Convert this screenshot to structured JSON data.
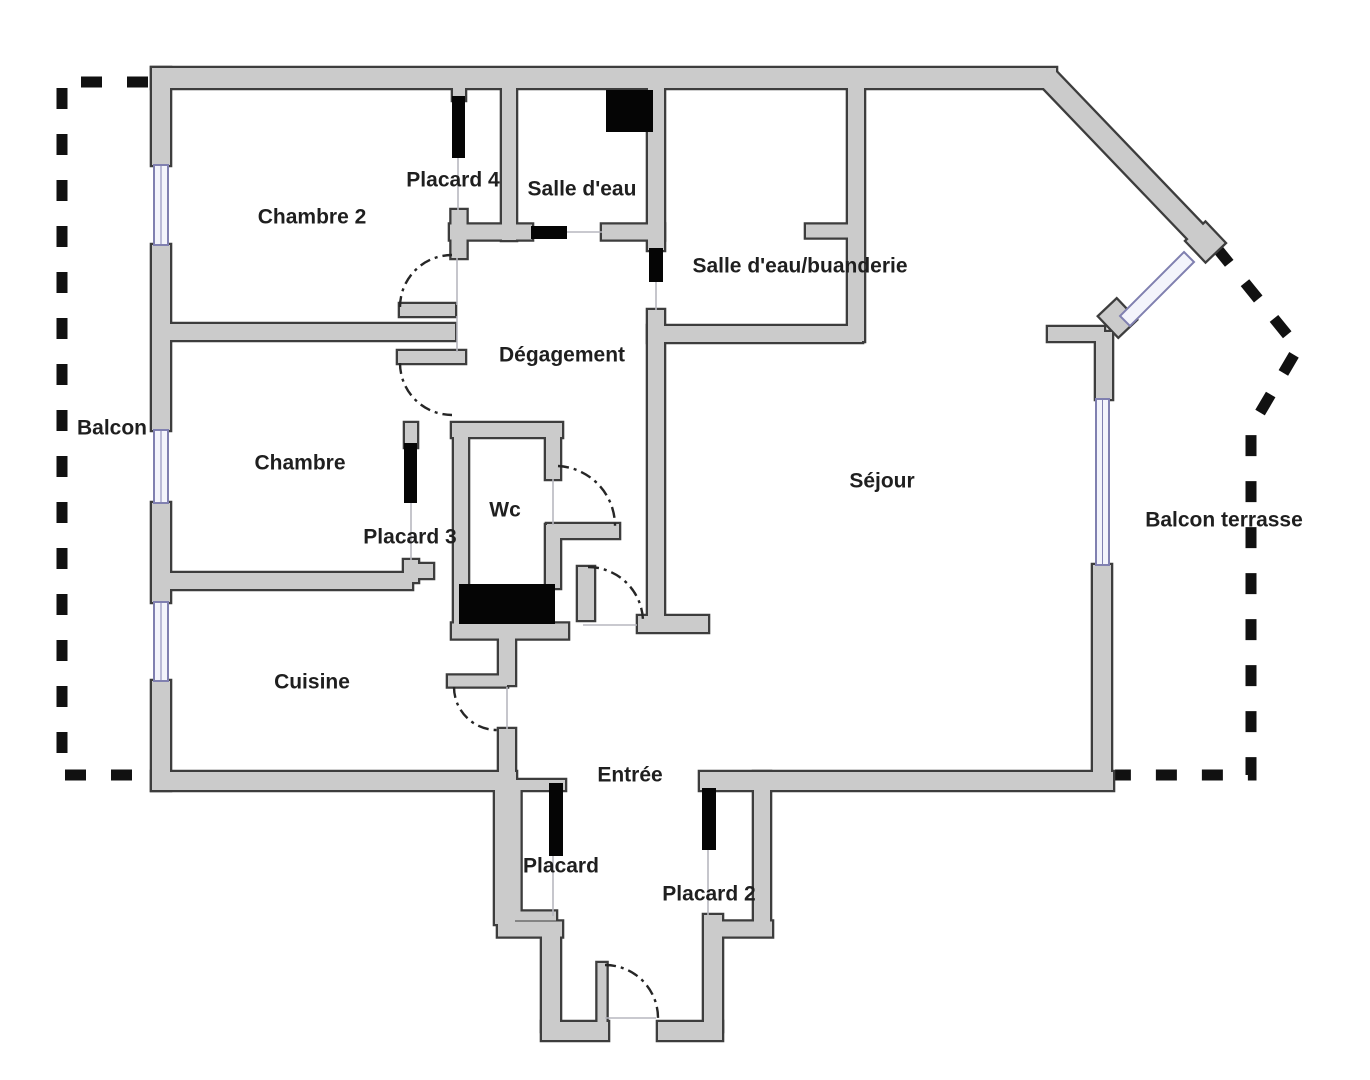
{
  "plan": {
    "kind": "apartment-floor-plan",
    "rooms": [
      {
        "id": "balcon",
        "label": "Balcon"
      },
      {
        "id": "chambre2",
        "label": "Chambre 2"
      },
      {
        "id": "placard4",
        "label": "Placard 4"
      },
      {
        "id": "salle_deau",
        "label": "Salle d'eau"
      },
      {
        "id": "buanderie",
        "label": "Salle d'eau/buanderie"
      },
      {
        "id": "degagement",
        "label": "Dégagement"
      },
      {
        "id": "chambre",
        "label": "Chambre"
      },
      {
        "id": "sejour",
        "label": "Séjour"
      },
      {
        "id": "balcon_terrasse",
        "label": "Balcon terrasse"
      },
      {
        "id": "wc",
        "label": "Wc"
      },
      {
        "id": "placard3",
        "label": "Placard 3"
      },
      {
        "id": "cuisine",
        "label": "Cuisine"
      },
      {
        "id": "entree",
        "label": "Entrée"
      },
      {
        "id": "placard",
        "label": "Placard"
      },
      {
        "id": "placard2",
        "label": "Placard 2"
      }
    ],
    "colors": {
      "background": "#ffffff",
      "wall_fill": "#cbcbcb",
      "wall_outline": "#3d3d3d",
      "window_stroke": "#8080b0",
      "window_fill": "#f3f4fb",
      "fixture_black": "#050505",
      "door_arc": "#262626",
      "balcony_dash": "#111111",
      "threshold": "#b7b7bf",
      "label_text": "#1f1f1f"
    }
  }
}
